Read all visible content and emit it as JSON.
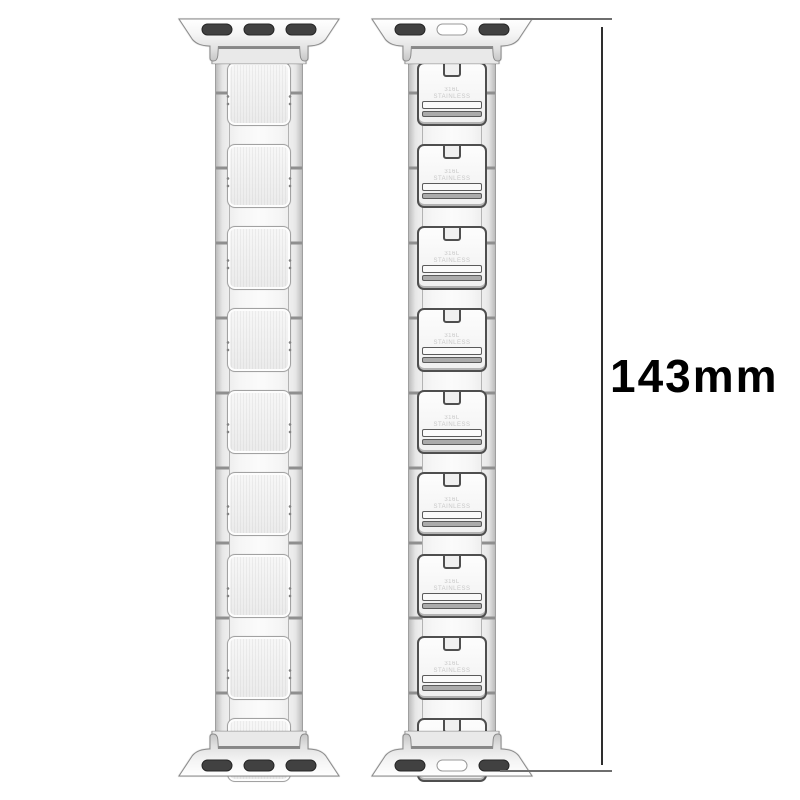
{
  "annotation": {
    "length_label": "143mm",
    "line_color": "#2e2e2e",
    "text_color": "#000000"
  },
  "bands": {
    "front": {
      "view": "front",
      "link_count": 9,
      "adapter_slots": [
        "dark",
        "dark",
        "dark"
      ]
    },
    "back": {
      "view": "back",
      "link_count": 9,
      "adapter_slots": [
        "dark",
        "light",
        "dark"
      ],
      "engraving_line1": "316L",
      "engraving_line2": "STAINLESS"
    }
  },
  "colors": {
    "background": "#ffffff",
    "metal_light": "#f7f7f7",
    "metal_mid": "#ececec",
    "metal_edge": "#c9c9c9",
    "outline": "#9f9f9f",
    "clasp_outline": "#4f4f4f",
    "slot_dark": "#414141",
    "slot_light": "#ffffff"
  }
}
